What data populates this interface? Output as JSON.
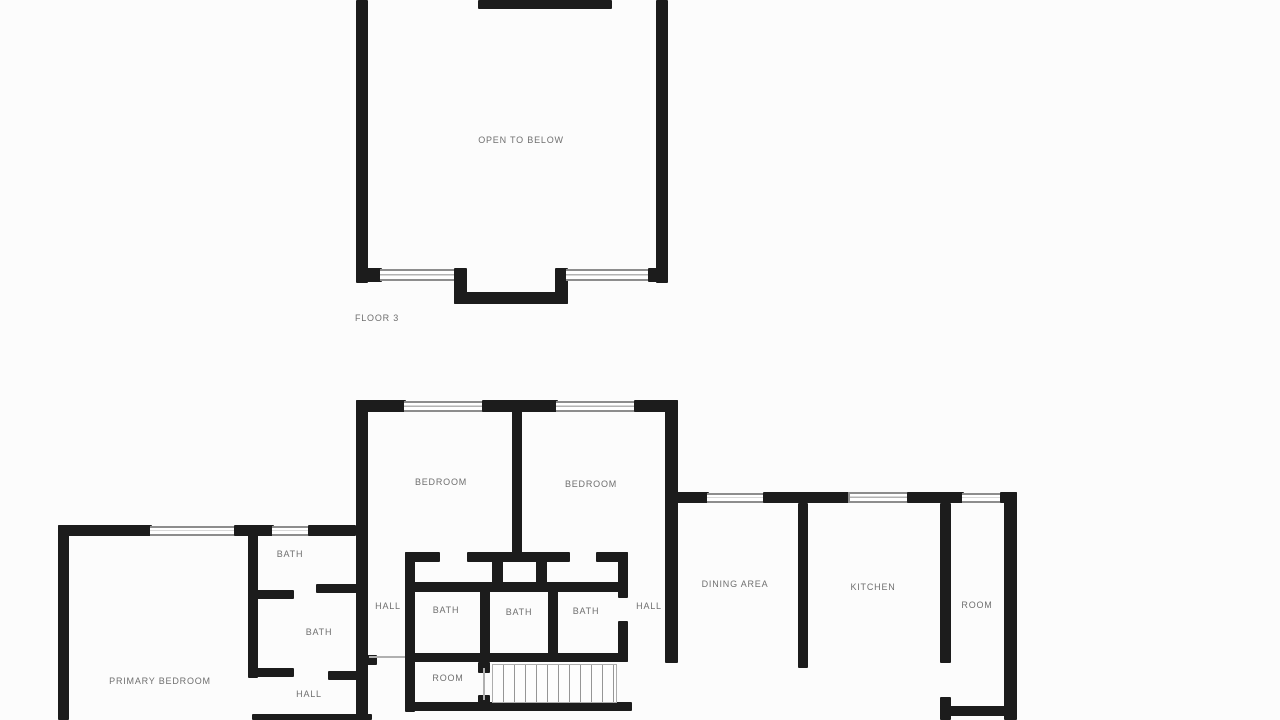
{
  "colors": {
    "background": "#fcfcfc",
    "wall": "#1c1c1c",
    "label": "#6f6f6f"
  },
  "floor3": {
    "open_to_below": "OPEN TO BELOW",
    "caption": "FLOOR 3"
  },
  "floor2": {
    "bedroom_left": "BEDROOM",
    "bedroom_right": "BEDROOM",
    "bath_upper_left": "BATH",
    "bath_lower_left": "BATH",
    "bath_center_1": "BATH",
    "bath_center_2": "BATH",
    "bath_center_3": "BATH",
    "hall_left": "HALL",
    "hall_right": "HALL",
    "hall_bottom_left": "HALL",
    "dining_area": "DINING AREA",
    "kitchen": "KITCHEN",
    "room_far_right": "ROOM",
    "room_center": "ROOM",
    "primary_bedroom": "PRIMARY BEDROOM"
  }
}
